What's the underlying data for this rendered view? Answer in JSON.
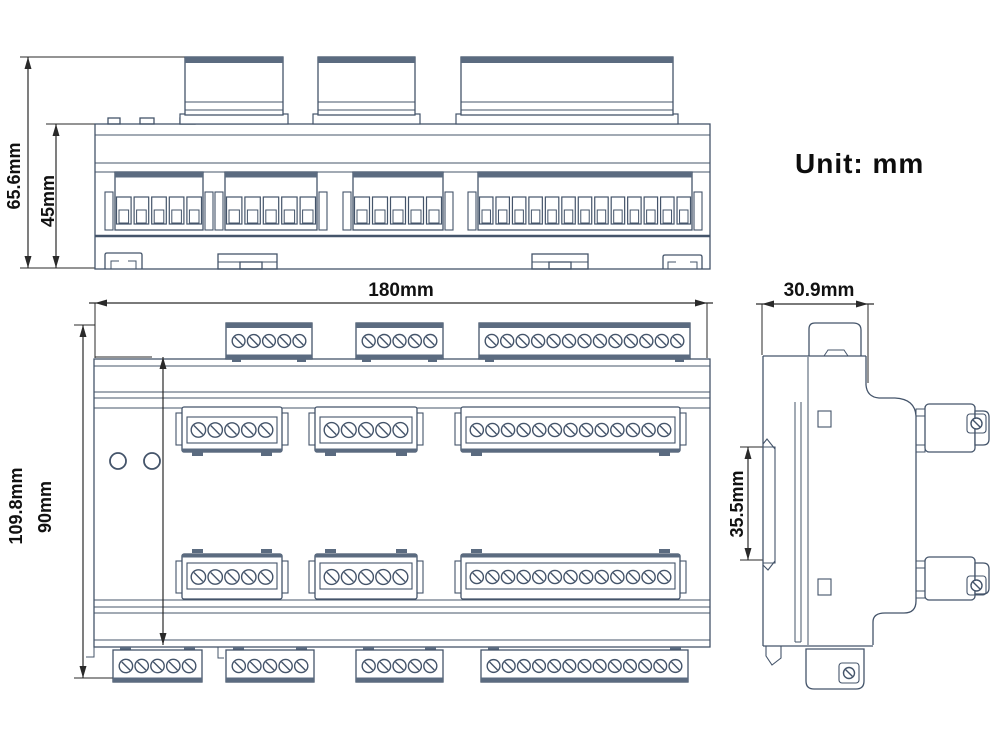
{
  "unit_note": "Unit: mm",
  "colors": {
    "line_color": "#44546a",
    "band_color": "#5b6b80",
    "dim_color": "#2a2a2a",
    "background": "#ffffff"
  },
  "dimensions": {
    "top_view_total_height": {
      "label": "65.6mm",
      "orient": "v",
      "x": 28,
      "y1": 57,
      "y2": 268
    },
    "top_view_body_height": {
      "label": "45mm",
      "orient": "v",
      "x": 56,
      "y1": 124,
      "y2": 268
    },
    "front_view_width": {
      "label": "180mm",
      "orient": "h",
      "y": 303,
      "x1": 95,
      "x2": 707
    },
    "front_view_total_height": {
      "label": "109.8mm",
      "orient": "v",
      "x": 83,
      "y1": 325,
      "y2": 678
    },
    "front_view_body_height": {
      "label": "90mm",
      "orient": "v",
      "x": 163,
      "y1": 357,
      "y2": 645
    },
    "side_view_depth": {
      "label": "30.9mm",
      "orient": "h",
      "y": 304,
      "x1": 762,
      "x2": 868
    },
    "din_rail_height": {
      "label": "35.5mm",
      "orient": "v",
      "x": 748,
      "y1": 447,
      "y2": 560
    }
  },
  "top_view": {
    "connectors": [
      {
        "name": "ct-connector-1",
        "x": 185,
        "w": 98
      },
      {
        "name": "ct-connector-2",
        "x": 318,
        "w": 97
      },
      {
        "name": "ct-connector-3",
        "x": 461,
        "w": 212
      }
    ],
    "terminal_groups": [
      {
        "x": 115,
        "w": 88,
        "cells": 5
      },
      {
        "x": 225,
        "w": 92,
        "cells": 5
      },
      {
        "x": 353,
        "w": 90,
        "cells": 5
      },
      {
        "x": 478,
        "w": 214,
        "cells": 13
      }
    ]
  },
  "front_view": {
    "top_row_blocks": [
      {
        "x": 226,
        "w": 86,
        "screws": 5
      },
      {
        "x": 356,
        "w": 87,
        "screws": 5
      },
      {
        "x": 479,
        "w": 211,
        "screws": 13
      }
    ],
    "upper_mid_blocks": [
      {
        "x": 182,
        "w": 100,
        "screws": 5
      },
      {
        "x": 315,
        "w": 102,
        "screws": 5
      },
      {
        "x": 461,
        "w": 219,
        "screws": 13
      }
    ],
    "lower_mid_blocks": [
      {
        "x": 182,
        "w": 100,
        "screws": 5
      },
      {
        "x": 315,
        "w": 102,
        "screws": 5
      },
      {
        "x": 461,
        "w": 219,
        "screws": 13
      }
    ],
    "bottom_row_blocks": [
      {
        "x": 113,
        "w": 89,
        "screws": 5
      },
      {
        "x": 226,
        "w": 88,
        "screws": 5
      },
      {
        "x": 356,
        "w": 87,
        "screws": 5
      },
      {
        "x": 481,
        "w": 207,
        "screws": 13
      }
    ],
    "leds": [
      {
        "cx": 118,
        "cy": 461,
        "r": 8
      },
      {
        "cx": 152,
        "cy": 461,
        "r": 8
      }
    ]
  },
  "side_view": {
    "screws": [
      {
        "cx": 976.5,
        "cy": 423.5
      },
      {
        "cx": 976.5,
        "cy": 585.5
      },
      {
        "cx": 849,
        "cy": 673
      }
    ]
  }
}
